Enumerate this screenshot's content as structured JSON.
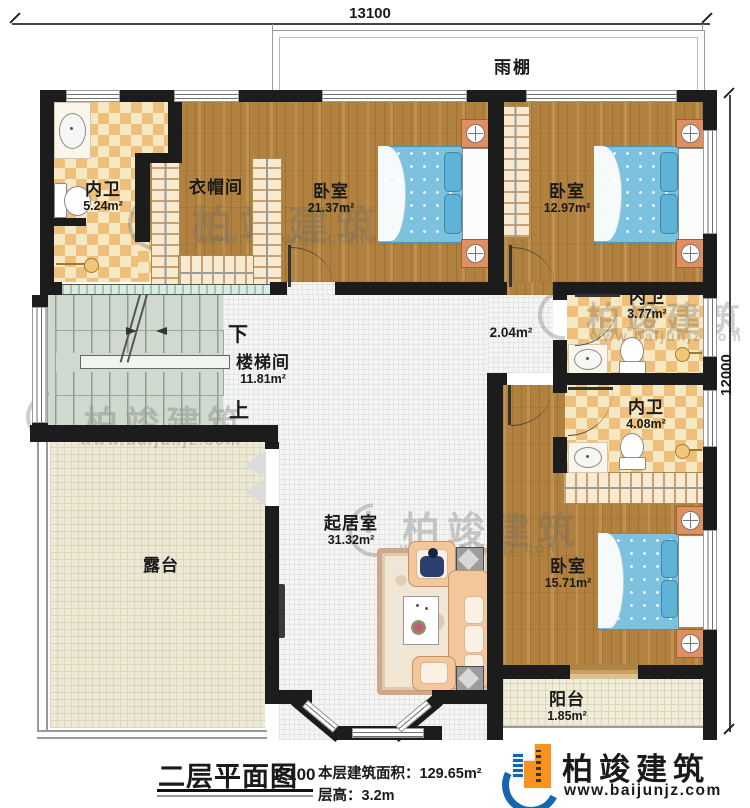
{
  "dimensions": {
    "top": "13100",
    "right": "12000"
  },
  "canopy_label": "雨棚",
  "rooms": [
    {
      "name": "内卫",
      "area": "5.24m²"
    },
    {
      "name": "衣帽间",
      "area": ""
    },
    {
      "name": "卧室",
      "area": "21.37m²"
    },
    {
      "name": "卧室",
      "area": "12.97m²"
    },
    {
      "name": "楼梯间",
      "area": "11.81m²"
    },
    {
      "name": "",
      "area": "2.04m²"
    },
    {
      "name": "内卫",
      "area": "3.77m²"
    },
    {
      "name": "内卫",
      "area": "4.08m²"
    },
    {
      "name": "起居室",
      "area": "31.32m²"
    },
    {
      "name": "露台",
      "area": ""
    },
    {
      "name": "卧室",
      "area": "15.71m²"
    },
    {
      "name": "阳台",
      "area": "1.85m²"
    }
  ],
  "stairs": {
    "down": "下",
    "up": "上"
  },
  "legend": {
    "title": "二层平面图",
    "scale": "1:100",
    "area_label": "本层建筑面积：",
    "area_value": "129.65m²",
    "floor_height_label": "层高：",
    "floor_height_value": "3.2m"
  },
  "brand": {
    "name": "柏竣建筑",
    "website": "www.baijunjz.com"
  },
  "watermark": {
    "name": "柏竣建筑",
    "website": "www.baijunjz.com"
  },
  "colors": {
    "accent_blue": "#1565b0",
    "accent_orange": "#f6941d",
    "wall": "#1c1c1c",
    "wood": "#b1813f"
  }
}
